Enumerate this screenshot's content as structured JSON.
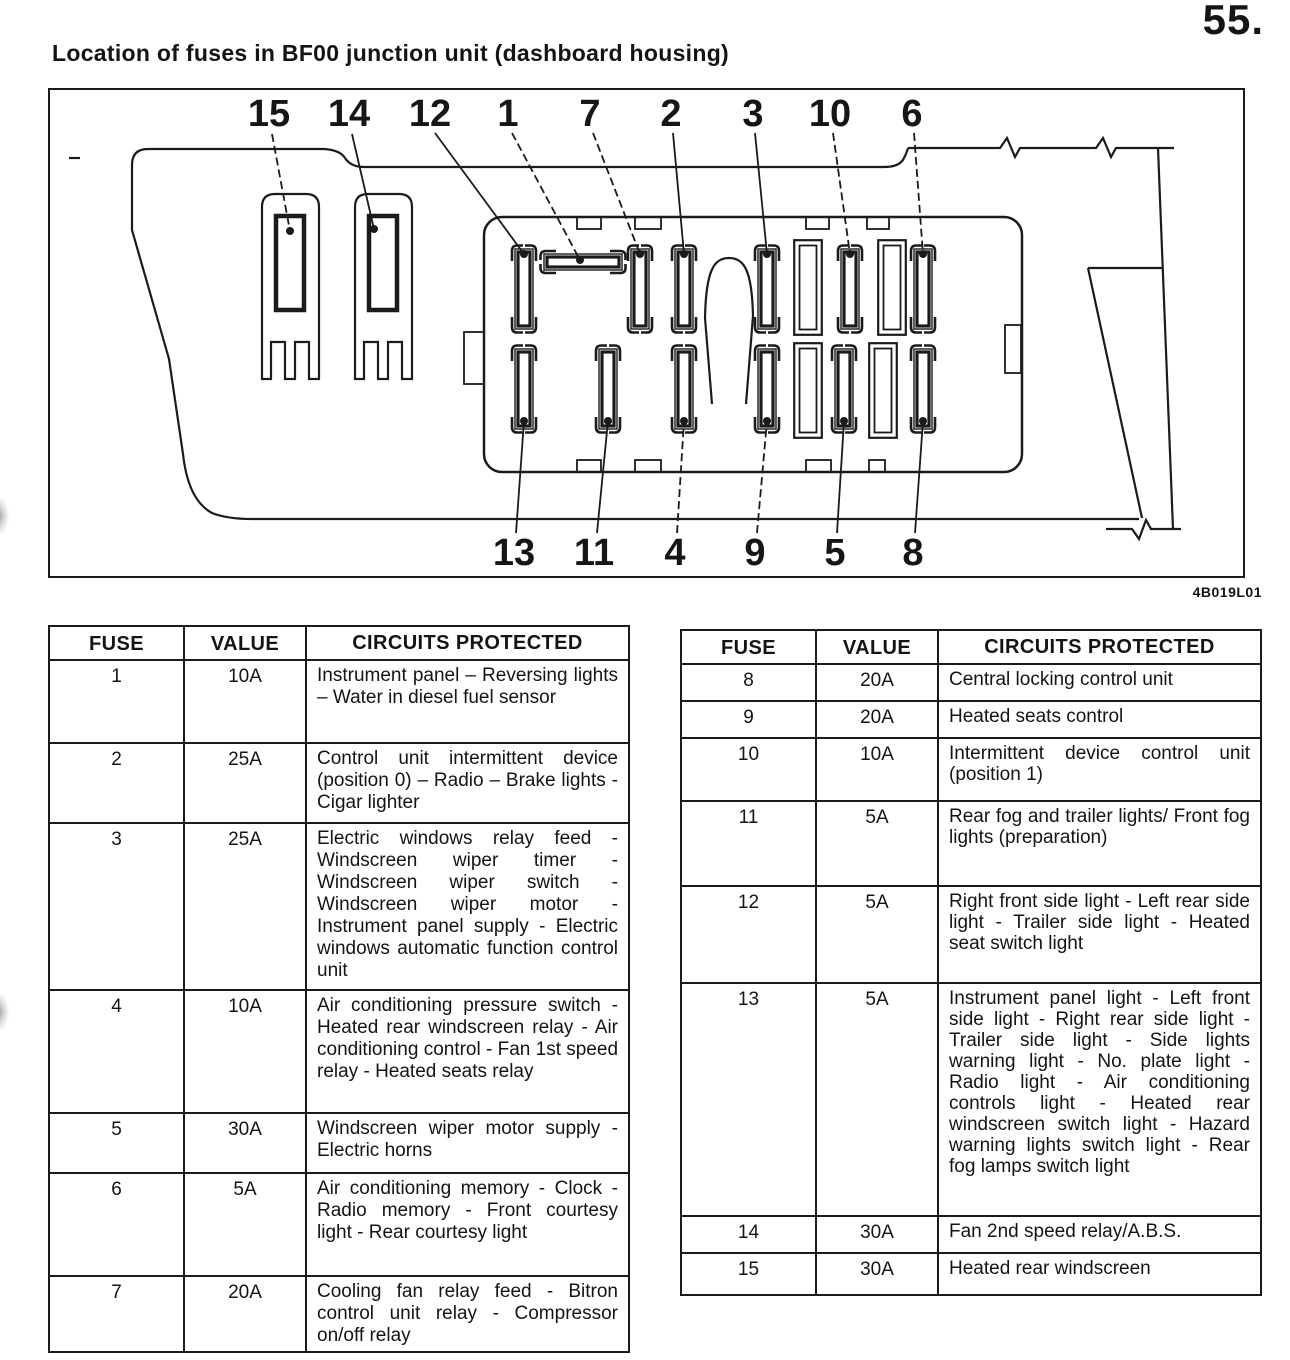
{
  "page": {
    "number": "55.",
    "title": "Location of fuses in BF00 junction unit (dashboard housing)",
    "figure_code": "4B019L01"
  },
  "diagram": {
    "description": "Fuse and relay location drawing of the BF00 junction unit seen from the dashboard housing",
    "top_callouts": [
      "15",
      "14",
      "12",
      "1",
      "7",
      "2",
      "3",
      "10",
      "6"
    ],
    "bottom_callouts": [
      "13",
      "11",
      "4",
      "9",
      "5",
      "8"
    ]
  },
  "tables": {
    "headers": {
      "fuse": "FUSE",
      "value": "VALUE",
      "circuits": "CIRCUITS PROTECTED"
    },
    "left_rows": [
      {
        "fuse": "1",
        "value": "10A",
        "circuits": "Instrument panel – Reversing lights – Water in diesel fuel sensor"
      },
      {
        "fuse": "2",
        "value": "25A",
        "circuits": "Control unit intermittent device (position 0) – Radio – Brake lights - Cigar lighter"
      },
      {
        "fuse": "3",
        "value": "25A",
        "circuits": "Electric windows relay feed - Windscreen wiper timer - Windscreen wiper switch - Windscreen wiper motor - Instrument panel supply - Electric windows automatic function control unit"
      },
      {
        "fuse": "4",
        "value": "10A",
        "circuits": "Air conditioning pressure switch - Heated rear windscreen relay - Air conditioning control - Fan 1st speed relay - Heated seats relay"
      },
      {
        "fuse": "5",
        "value": "30A",
        "circuits": "Windscreen wiper motor supply - Electric horns"
      },
      {
        "fuse": "6",
        "value": "5A",
        "circuits": "Air conditioning memory - Clock - Radio memory - Front courtesy light - Rear courtesy light"
      },
      {
        "fuse": "7",
        "value": "20A",
        "circuits": "Cooling fan relay feed - Bitron control unit relay - Compressor on/off relay"
      }
    ],
    "right_rows": [
      {
        "fuse": "8",
        "value": "20A",
        "circuits": "Central locking control unit"
      },
      {
        "fuse": "9",
        "value": "20A",
        "circuits": "Heated seats control"
      },
      {
        "fuse": "10",
        "value": "10A",
        "circuits": "Intermittent device control unit (position 1)"
      },
      {
        "fuse": "11",
        "value": "5A",
        "circuits": "Rear fog and trailer lights/ Front fog lights (preparation)"
      },
      {
        "fuse": "12",
        "value": "5A",
        "circuits": "Right front side light - Left rear side light - Trailer side light - Heated seat switch light"
      },
      {
        "fuse": "13",
        "value": "5A",
        "circuits": "Instrument panel light - Left front side light - Right rear side light - Trailer side light - Side lights warning light - No. plate light - Radio light - Air conditioning controls light - Heated rear windscreen switch light - Hazard warning lights switch light - Rear fog lamps switch light"
      },
      {
        "fuse": "14",
        "value": "30A",
        "circuits": "Fan 2nd speed relay/A.B.S."
      },
      {
        "fuse": "15",
        "value": "30A",
        "circuits": "Heated rear windscreen"
      }
    ]
  }
}
